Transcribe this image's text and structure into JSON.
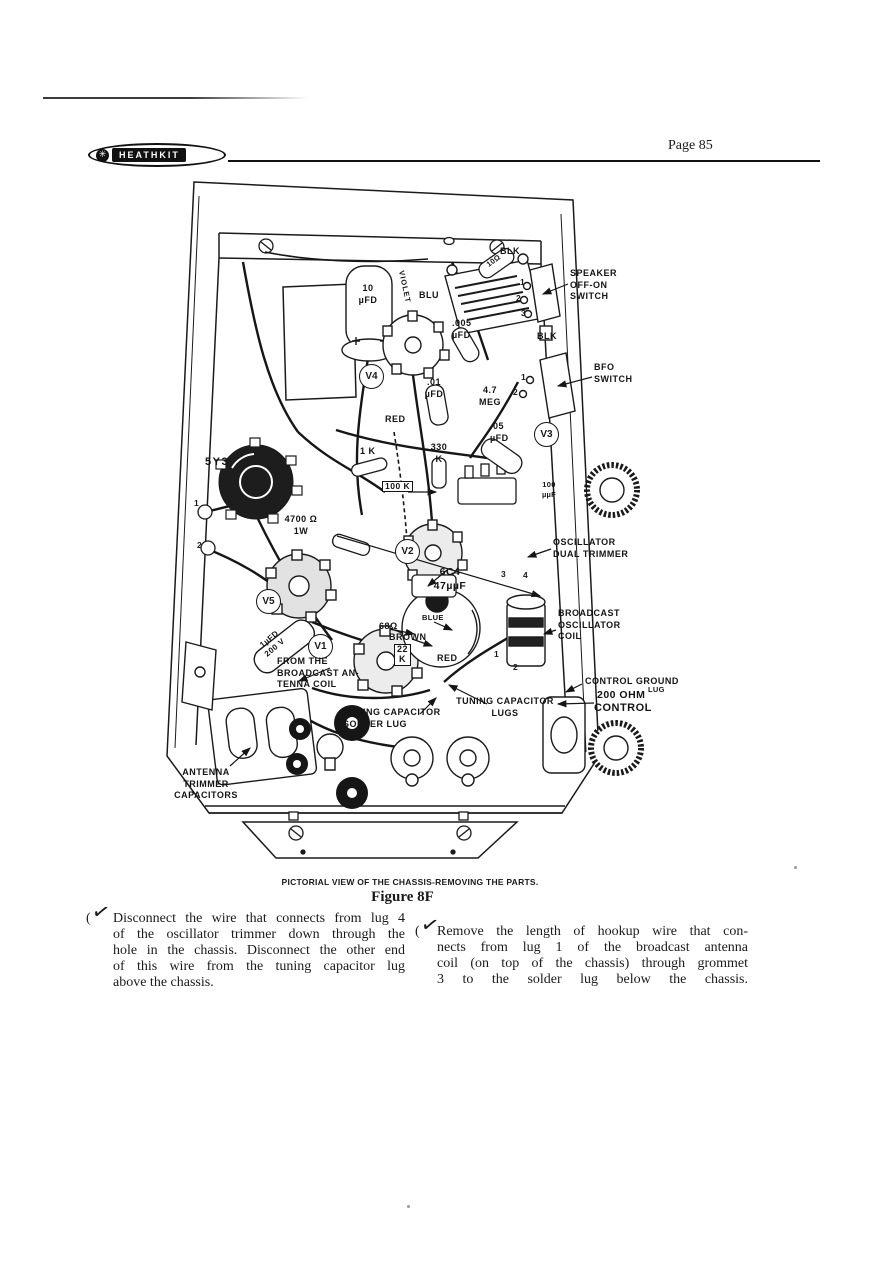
{
  "header": {
    "brand": "HEATHKIT",
    "page_label": "Page 85"
  },
  "figure": {
    "caption": "PICTORIAL VIEW OF THE CHASSIS-REMOVING THE PARTS.",
    "title": "Figure 8F",
    "labels": {
      "blk_top": "BLK",
      "speaker_switch": "SPEAKER\nOFF-ON\nSWITCH",
      "blk_mid": "BLK",
      "bfo_switch": "BFO\nSWITCH",
      "cap_10ufd": "10\nµFD",
      "wire_blu": "BLU",
      "cap_005ufd": ".005\nµFD",
      "tube_v4": "V4",
      "cap_01ufd": ".01\nµFD",
      "res_4_7meg": "4.7\nMEG",
      "wire_red_upper": "RED",
      "cap_05ufd": ".05\nµFD",
      "tube_v3": "V3",
      "res_1k": "1 K",
      "res_330k": "330\nK",
      "tube_5y3": "5Y3",
      "res_100k": "100 K",
      "cap_100uuf": "100\nµµF",
      "res_4700": "4700 Ω\n1W",
      "tube_v2": "V2",
      "oscillator_trimmer": "OSCILLATOR\nDUAL TRIMMER",
      "tube_6c4": "6C4\n47µµF",
      "tube_v5": "V5",
      "wire_blue": "BLUE",
      "res_68": "68Ω",
      "wire_brown": "BROWN",
      "broadcast_coil": "BROADCAST\nOSCILLATOR\nCOIL",
      "cap_1ufd": ".1µFD\n200 V",
      "tube_v1": "V1",
      "res_22k": "22\nK",
      "wire_red_lower": "RED",
      "from_antenna": "FROM  THE\nBROADCAST AN-\nTENNA  COIL",
      "control_ground": "CONTROL  GROUND",
      "control_ground_lug": "LUG",
      "control_200ohm": "200 OHM",
      "control_control": "CONTROL",
      "res_10ohm": "10Ω",
      "wire_violet": "VIOLET",
      "tuning_solder_lug": "TUNING  CAPACITOR\nSOLDER  LUG",
      "tuning_lugs": "TUNING  CAPACITOR\nLUGS",
      "antenna_trimmers": "ANTENNA\nTRIMMER\nCAPACITORS"
    },
    "lug_numbers": {
      "speaker": [
        "1",
        "2",
        "3"
      ],
      "bfo": [
        "1",
        "2"
      ],
      "left_edge": [
        "1",
        "2"
      ],
      "osc_coil": [
        "3",
        "4"
      ],
      "coil_bottom": [
        "1",
        "2"
      ]
    }
  },
  "instructions": {
    "left": {
      "paren": "(",
      "check": "✓",
      "lines": [
        "Disconnect the wire that connects from lug 4",
        "of the oscillator trimmer down through the",
        "hole in the chassis. Disconnect the other end",
        "of this wire from the tuning capacitor lug",
        "above the chassis."
      ]
    },
    "right": {
      "paren": "(",
      "check": "✓",
      "lines": [
        "Remove the length of hookup wire that con-",
        "nects from lug 1 of the broadcast antenna",
        "coil (on top of the chassis) through grommet",
        "3 to the solder lug below the chassis."
      ]
    }
  },
  "colors": {
    "ink": "#1a1a1a",
    "paper": "#ffffff"
  }
}
